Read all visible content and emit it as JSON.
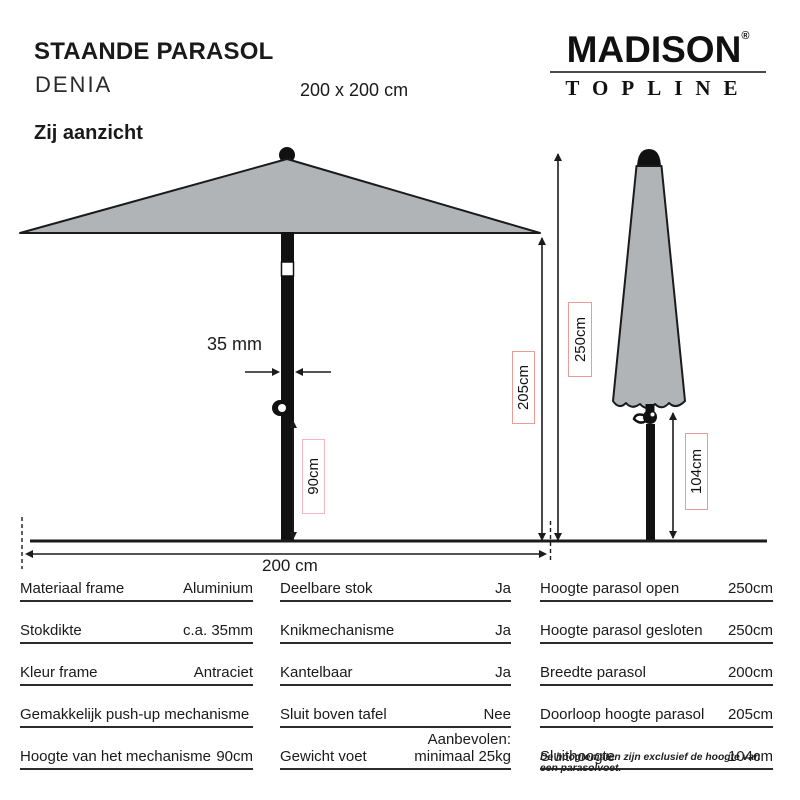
{
  "header": {
    "title": "STAANDE PARASOL",
    "model": "DENIA",
    "size": "200 x 200 cm"
  },
  "logo": {
    "brand": "MADISON",
    "mark": "®",
    "subbrand": "TOPLINE"
  },
  "section": {
    "view_label": "Zij aanzicht"
  },
  "diagram": {
    "pole_thickness": "35 mm",
    "mechanism_height": "90cm",
    "walkthrough_height": "205cm",
    "open_height": "250cm",
    "closed_bottom_height": "104cm",
    "width": "200 cm",
    "canopy_color": "#b0b4b6",
    "frame_color": "#111111",
    "dim_box_border_color": "#ea9c96"
  },
  "table": {
    "col1": [
      {
        "label": "Materiaal frame",
        "value": "Aluminium"
      },
      {
        "label": "Stokdikte",
        "value": "c.a. 35mm"
      },
      {
        "label": "Kleur frame",
        "value": "Antraciet"
      },
      {
        "label": "Gemakkelijk push-up mechanisme",
        "value": ""
      },
      {
        "label": "Hoogte van het mechanisme",
        "value": "90cm"
      }
    ],
    "col2": [
      {
        "label": "Deelbare stok",
        "value": "Ja"
      },
      {
        "label": "Knikmechanisme",
        "value": "Ja"
      },
      {
        "label": "Kantelbaar",
        "value": "Ja"
      },
      {
        "label": "Sluit boven tafel",
        "value": "Nee"
      },
      {
        "label": "Gewicht voet",
        "value": "Aanbevolen:\nminimaal 25kg"
      }
    ],
    "col3": [
      {
        "label": "Hoogte parasol open",
        "value": "250cm"
      },
      {
        "label": "Hoogte parasol gesloten",
        "value": "250cm"
      },
      {
        "label": "Breedte parasol",
        "value": "200cm"
      },
      {
        "label": "Doorloop hoogte parasol",
        "value": "205cm"
      },
      {
        "label": "Sluithoogte",
        "value": "104cm"
      }
    ]
  },
  "footnote": "De hoogtematen zijn exclusief de hoogte van een parasolvoet."
}
